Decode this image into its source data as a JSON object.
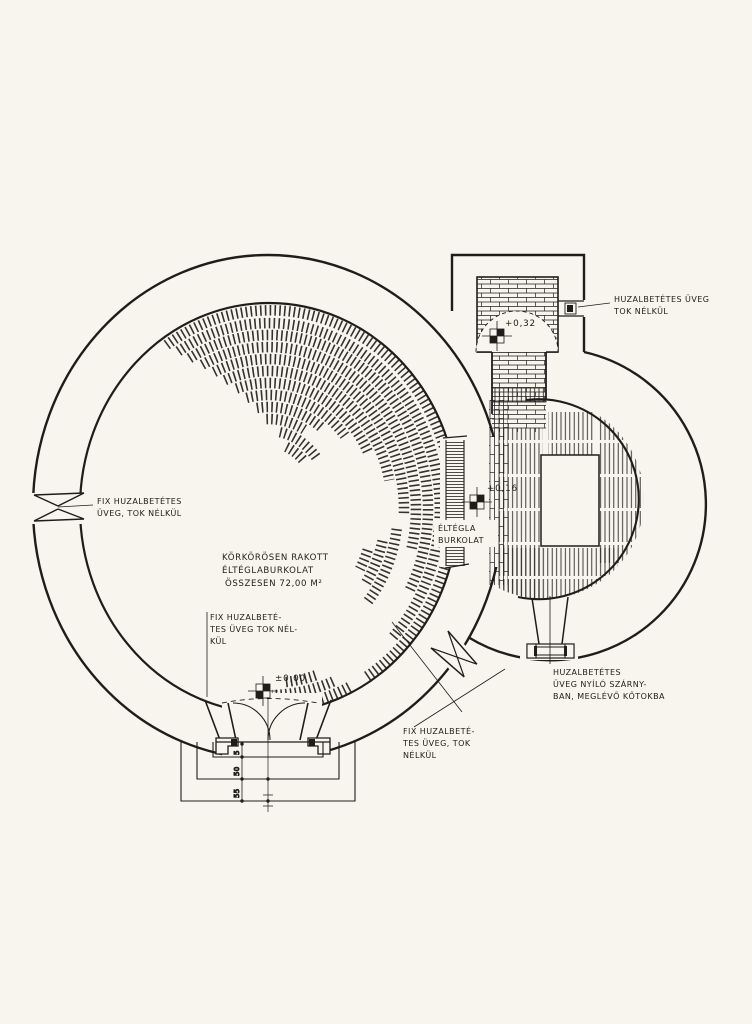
{
  "drawing": {
    "type": "architectural-floor-plan",
    "language": "Hungarian",
    "labels": {
      "annex_window": {
        "line1": "HUZALBETÉTES ÜVEG",
        "line2": "TOK NÉLKÜL"
      },
      "left_window": {
        "line1": "FIX HUZALBETÉTES",
        "line2": "ÜVEG, TOK NÉLKÜL"
      },
      "floor_note": {
        "line1": "KÖRKÖRÖSEN RAKOTT",
        "line2": "ÉLTÉGLABURKOLAT",
        "line3": "ÖSSZESEN 72,00 M²"
      },
      "entrance_window": {
        "line1": "FIX HUZALBETÉ-",
        "line2": "TES ÜVEG TOK NÉL-",
        "line3": "KÜL"
      },
      "junction_window": {
        "line1": "FIX HUZALBETÉ-",
        "line2": "TES ÜVEG, TOK",
        "line3": "NÉLKÜL"
      },
      "right_door": {
        "line1": "HUZALBETÉTES",
        "line2": "ÜVEG NYÍLÓ SZÁRNY-",
        "line3": "BAN, MEGLÉVŐ KŐTOKBA"
      },
      "passage_floor": {
        "line1": "ÉLTÉGLA",
        "line2": "BURKOLAT"
      }
    },
    "levels": {
      "entrance": "±0,00",
      "passage": "+0,16",
      "annex": "+0,32"
    },
    "dimensions": {
      "step_depths": [
        "5",
        "50",
        "55"
      ]
    },
    "colors": {
      "paper": "#f8f5ee",
      "ink": "#1f1d1a"
    }
  }
}
